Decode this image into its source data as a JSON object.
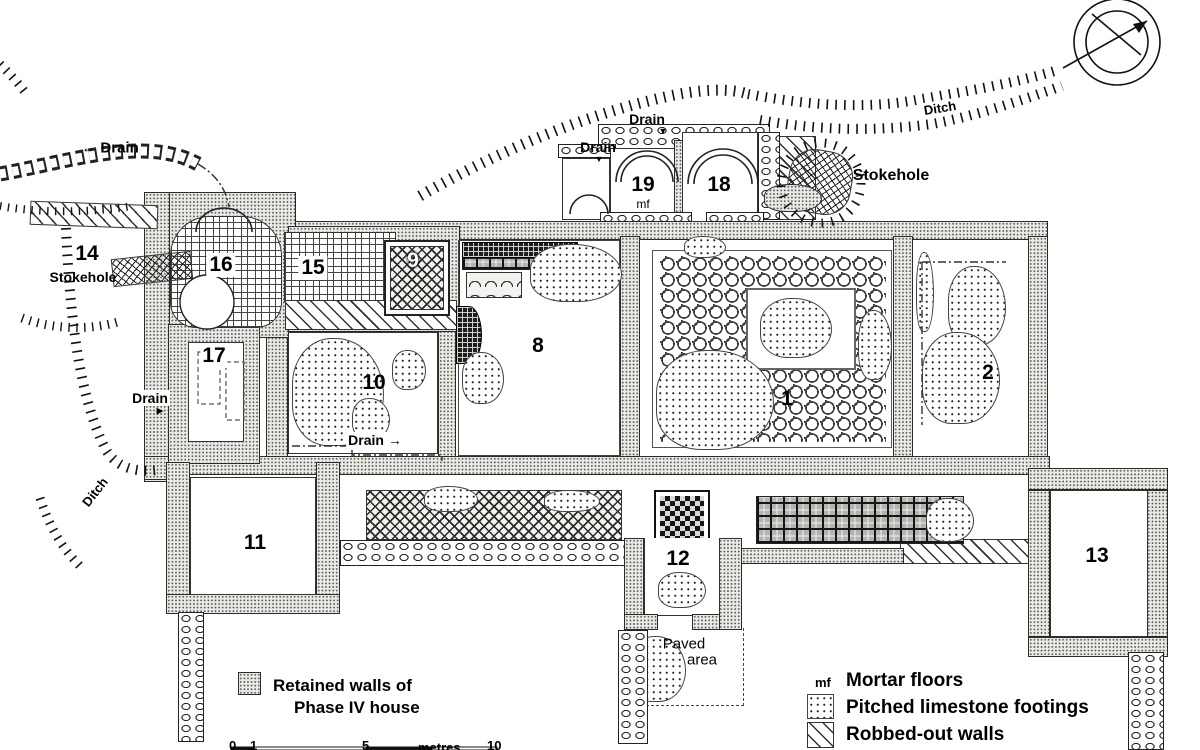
{
  "plan": {
    "rooms": {
      "1": "1",
      "2": "2",
      "8": "8",
      "9": "9",
      "10": "10",
      "11": "11",
      "12": "12",
      "13": "13",
      "14": "14",
      "15": "15",
      "16": "16",
      "17": "17",
      "18": "18",
      "19": "19"
    },
    "room_19_floor": "mf",
    "labels": {
      "drain": "Drain",
      "drain_left_arrow": "← Drain",
      "drain_right_arrow": "Drain →",
      "ditch": "Ditch",
      "stokehole": "Stokehole",
      "paved_line1": "Paved",
      "paved_line2": "area"
    },
    "icons": {
      "arrow_down": "▼",
      "arrow_right": "▶"
    },
    "legend": {
      "retained_line1": "Retained walls of",
      "retained_line2": "Phase IV house",
      "mf_abbrev": "mf",
      "mortar": "Mortar floors",
      "pitched": "Pitched limestone footings",
      "robbed": "Robbed-out walls"
    },
    "scale": {
      "t0": "0",
      "t1": "1",
      "t5": "5",
      "unit": "metres",
      "t10": "10"
    },
    "colors": {
      "ink": "#111111",
      "paper": "#ffffff",
      "wall_fill": "#ebe9e4"
    }
  }
}
